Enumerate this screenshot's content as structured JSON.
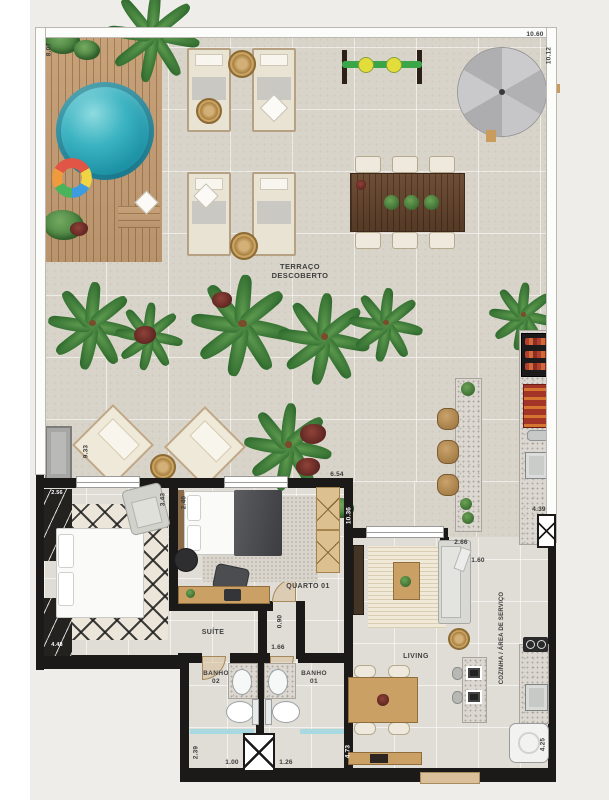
{
  "plan_title": "apartment-terrace-floor-plan",
  "labels": {
    "terraco_line1": "TERRAÇO",
    "terraco_line2": "DESCOBERTO",
    "suite": "SUÍTE",
    "quarto": "QUARTO 01",
    "banho01_line1": "BANHO",
    "banho01_line2": "01",
    "banho02_line1": "BANHO",
    "banho02_line2": "02",
    "living": "LIVING",
    "cozinha": "COZINHA / ÁREA DE SERVIÇO"
  },
  "dims": {
    "deck_height": "8.07",
    "terrace_width": "10.60",
    "terrace_height": "10.12",
    "terrace_mid_height": "9.33",
    "terrace_mid_width": "6.54",
    "suite_closet_top": "2.56",
    "suite_wall_right": "3.43",
    "suite_closet_bottom": "4.48",
    "quarto_wall_left": "2.40",
    "living_wall_left_top": "10.36",
    "corridor_width": "0.90",
    "hall_opening": "1.66",
    "banho_depth": "2.39",
    "banho02_width": "1.00",
    "banho01_width": "1.26",
    "living_wall_left_bottom": "4.73",
    "living_top": "2.66",
    "kitchen_passage": "1.60",
    "gourmet_counter": "4.39",
    "service_counter": "4.25"
  },
  "colors": {
    "wall_black": "#1b1a18",
    "parapet_white": "#fcfcfb",
    "terrace_tile": "#d8d4c9",
    "interior_tile": "#e0ddd6",
    "pool_water": "#1f95a8",
    "deck_wood": "#c7a178",
    "foliage_green": "#3d7837",
    "umbrella_gray": "#b1b1b4",
    "shower_glass_blue": "#a8d8e0"
  }
}
